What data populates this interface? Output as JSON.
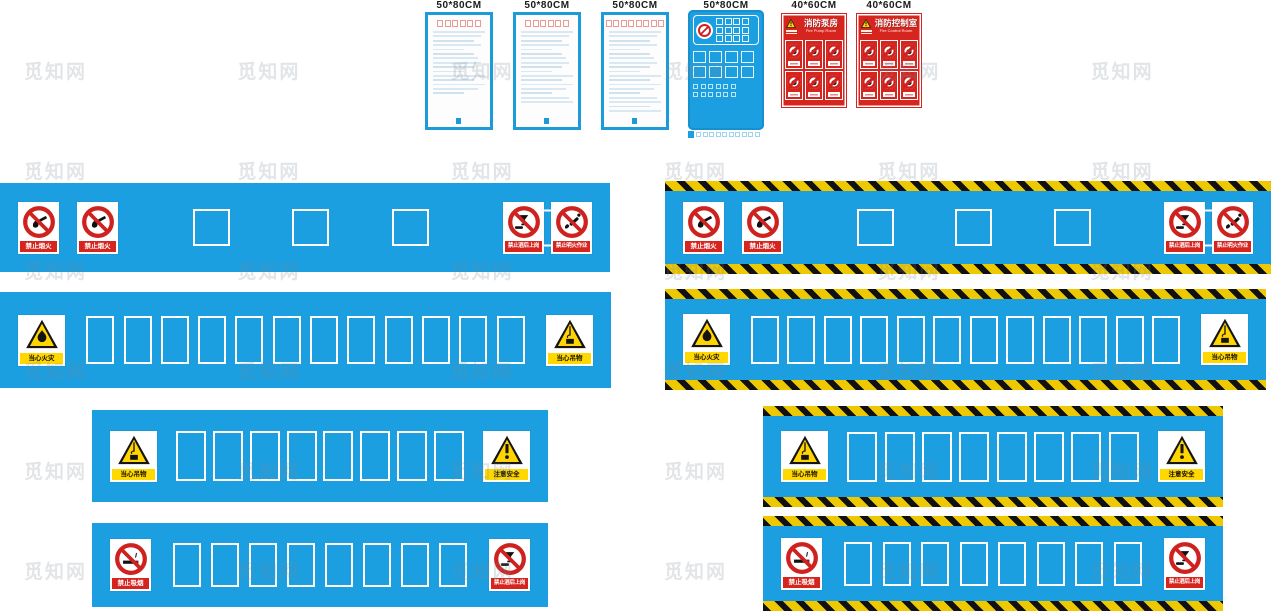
{
  "watermark": {
    "text": "觅知网",
    "count": 36
  },
  "top_row": {
    "doc_panels": [
      {
        "size": "50*80CM",
        "title_boxes": 6,
        "lines": 15
      },
      {
        "size": "50*80CM",
        "title_boxes": 6,
        "lines": 17
      },
      {
        "size": "50*80CM",
        "title_boxes": 8,
        "lines": 19
      }
    ],
    "blue_panel": {
      "size": "50*80CM",
      "top_squares": 12,
      "mid_squares": 8,
      "small_squares": 12,
      "caption_squares": 10
    },
    "red_panels": [
      {
        "size": "40*60CM",
        "title": "消防泵房",
        "subtitle": "Fire Pump Room",
        "cells": 6
      },
      {
        "size": "40*60CM",
        "title": "消防控制室",
        "subtitle": "Fire Control Room",
        "cells": 6
      }
    ]
  },
  "sign_labels": {
    "no_open_fire": "禁止烟火",
    "no_drink_on_duty": "禁止酒后上岗",
    "no_open_flame_work": "禁止明火作业",
    "no_smoking": "禁止吸烟",
    "warn_fire": "当心火灾",
    "warn_hanging": "当心吊物",
    "warn_safety": "注意安全"
  },
  "banners": {
    "row1_left": {
      "placeholders": 3
    },
    "row1_right": {
      "placeholders": 3
    },
    "row2_left": {
      "placeholders": 12
    },
    "row2_right": {
      "placeholders": 12
    },
    "row3_left": {
      "placeholders": 8
    },
    "row3_right": {
      "placeholders": 8
    },
    "row4_left": {
      "placeholders": 8
    },
    "row4_right": {
      "placeholders": 8
    }
  }
}
